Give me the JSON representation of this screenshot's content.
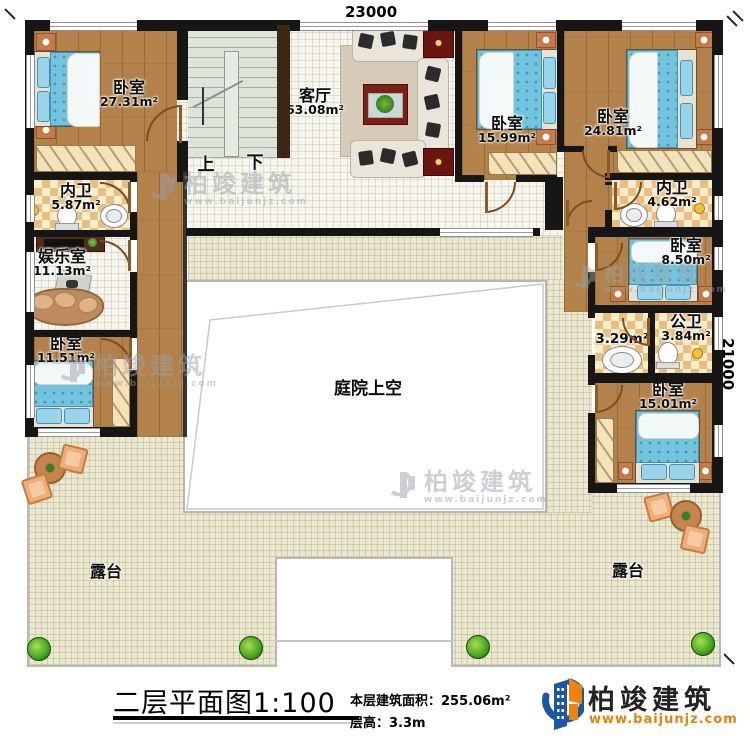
{
  "dimensions": {
    "width": "23000",
    "height": "21000"
  },
  "rooms": {
    "bedroom_tl": {
      "name": "卧室",
      "area": "27.31m²"
    },
    "bath_left": {
      "name": "内卫",
      "area": "5.87m²"
    },
    "entertainment": {
      "name": "娱乐室",
      "area": "11.13m²"
    },
    "bedroom_left": {
      "name": "卧室",
      "area": "11.51m²"
    },
    "living": {
      "name": "客厅",
      "area": "63.08m²"
    },
    "bedroom_r1": {
      "name": "卧室",
      "area": "15.99m²"
    },
    "bedroom_r2": {
      "name": "卧室",
      "area": "24.81m²"
    },
    "bath_right": {
      "name": "内卫",
      "area": "4.62m²"
    },
    "bedroom_r3": {
      "name": "卧室",
      "area": "8.50m²"
    },
    "wash": {
      "area": "3.29m²"
    },
    "bath_public": {
      "name": "公卫",
      "area": "3.84m²"
    },
    "bedroom_r4": {
      "name": "卧室",
      "area": "15.01m²"
    },
    "courtyard": {
      "name": "庭院上空"
    },
    "terrace_left": {
      "name": "露台"
    },
    "terrace_right": {
      "name": "露台"
    }
  },
  "stairs": {
    "up": "上",
    "down": "下"
  },
  "titleblock": {
    "title": "二层平面图1:100",
    "floor_area": "本层建筑面积：255.06m²",
    "floor_height": "层高：3.3m"
  },
  "logo": {
    "name": "柏竣建筑",
    "website": "www.baijunjz.com"
  },
  "watermark": {
    "name": "柏竣建筑",
    "website": "www.baijunjz.com"
  },
  "colors": {
    "wall": "#161616",
    "wood": "#b2824a",
    "bed": "#72c3de",
    "logo_blue": "#1c57a5",
    "logo_orange": "#f0830a"
  }
}
